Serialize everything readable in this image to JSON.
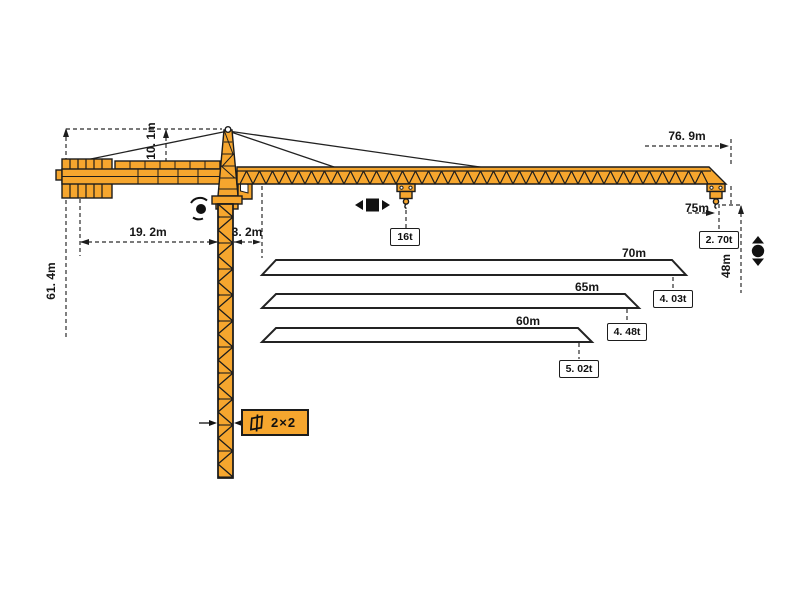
{
  "diagram_title": "tower crane working range diagram",
  "colors": {
    "crane_orange": "#f6a62e",
    "outline": "#1c1c1c",
    "dimension_line": "#2b2b2b"
  },
  "labels": {
    "total_height": "61. 4m",
    "tower_head_height": "10. 1m",
    "counter_jib_length": "19. 2m",
    "jib_root_offset": "3. 2m",
    "overall_reach": "76. 9m",
    "max_radius": "75m",
    "under_hook_height": "48m",
    "max_load": "16t",
    "tip_load": "2. 70t",
    "mast_section": "2×2"
  },
  "jib_options": [
    {
      "length": "70m",
      "capacity": "4. 03t"
    },
    {
      "length": "65m",
      "capacity": "4. 48t"
    },
    {
      "length": "60m",
      "capacity": "5. 02t"
    }
  ],
  "icons": [
    "slewing-icon",
    "trolley-travel-icon",
    "hoisting-icon",
    "mast-section-icon"
  ]
}
